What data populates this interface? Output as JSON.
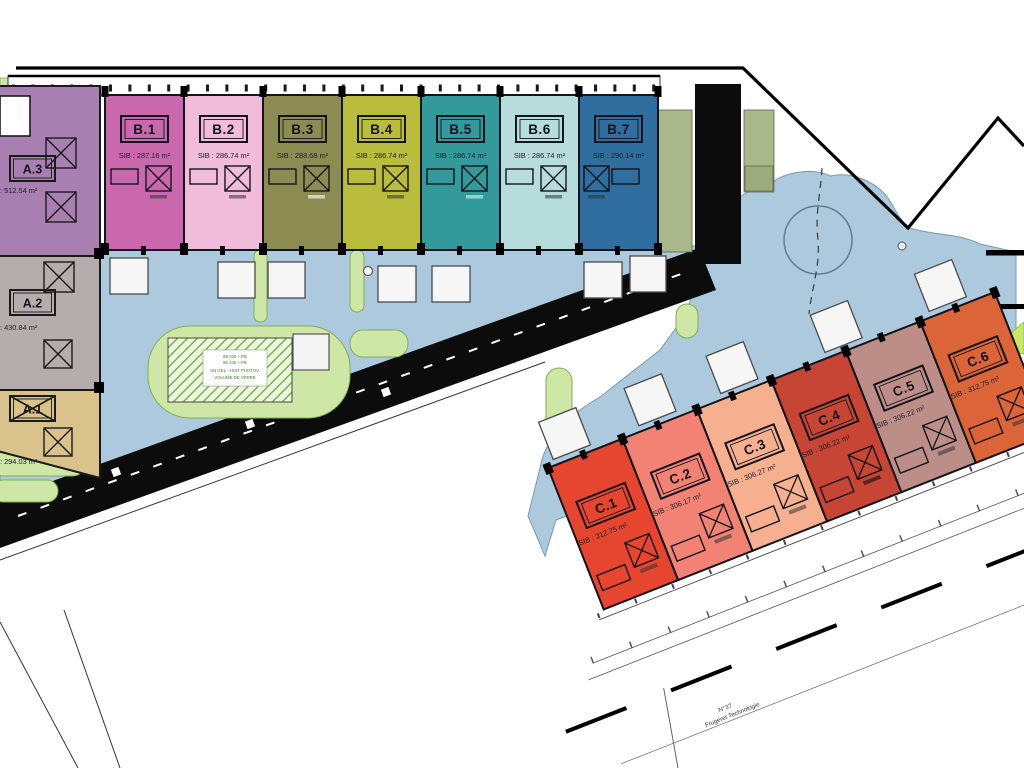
{
  "plan": {
    "title": "industrial-park-site-plan",
    "colors": {
      "paving": "#adc9dd",
      "green_island": "#cfe7a6",
      "green_block": "#a9b78b",
      "road": "#0c0c0c",
      "background": "#ffffff"
    },
    "buildings": {
      "a": {
        "units": [
          {
            "label": "A.3",
            "area": "SIB : 512.54 m²",
            "color": "#a77fb0"
          },
          {
            "label": "A.2",
            "area": "SIB : 430.84 m²",
            "color": "#b5adad"
          },
          {
            "label": "A.1",
            "area": "SIB : 294.03 m²",
            "color": "#dac28d"
          }
        ]
      },
      "b": {
        "units": [
          {
            "label": "B.1",
            "area": "SIB : 287.16 m²",
            "color": "#ca68ad"
          },
          {
            "label": "B.2",
            "area": "SIB : 286.74 m²",
            "color": "#f0bcd9"
          },
          {
            "label": "B.3",
            "area": "SIB : 288.68 m²",
            "color": "#8c8c52"
          },
          {
            "label": "B.4",
            "area": "SIB : 286.74 m²",
            "color": "#b9bc3c"
          },
          {
            "label": "B.5",
            "area": "SIB : 286.74 m²",
            "color": "#33999b"
          },
          {
            "label": "B.6",
            "area": "SIB : 286.74 m²",
            "color": "#b7dcdc"
          },
          {
            "label": "B.7",
            "area": "SIB : 290.14 m²",
            "color": "#2f6e9e"
          }
        ]
      },
      "c": {
        "units": [
          {
            "label": "C.1",
            "area": "SIB : 312.75 m²",
            "color": "#e64530"
          },
          {
            "label": "C.2",
            "area": "SIB : 306.17 m²",
            "color": "#f28273"
          },
          {
            "label": "C.3",
            "area": "SIB : 306.27 m²",
            "color": "#f6b090"
          },
          {
            "label": "C.4",
            "area": "SIB : 306.22 m²",
            "color": "#c64534"
          },
          {
            "label": "C.5",
            "area": "SIB : 306.22 m²",
            "color": "#bd8e88"
          },
          {
            "label": "C.6",
            "area": "SIB : 312.75 m²",
            "color": "#db6438"
          }
        ]
      }
    },
    "annotations": {
      "hatch_label": {
        "line1": "88 030 + PB",
        "line2": "86 235 + PB",
        "line3": "UN GEL - HUIT PHOTOV.",
        "line4": "VOLUME DE VERRE"
      },
      "parcel_note": {
        "line1": "N°37",
        "line2": "Frugeret Technologie"
      }
    }
  }
}
